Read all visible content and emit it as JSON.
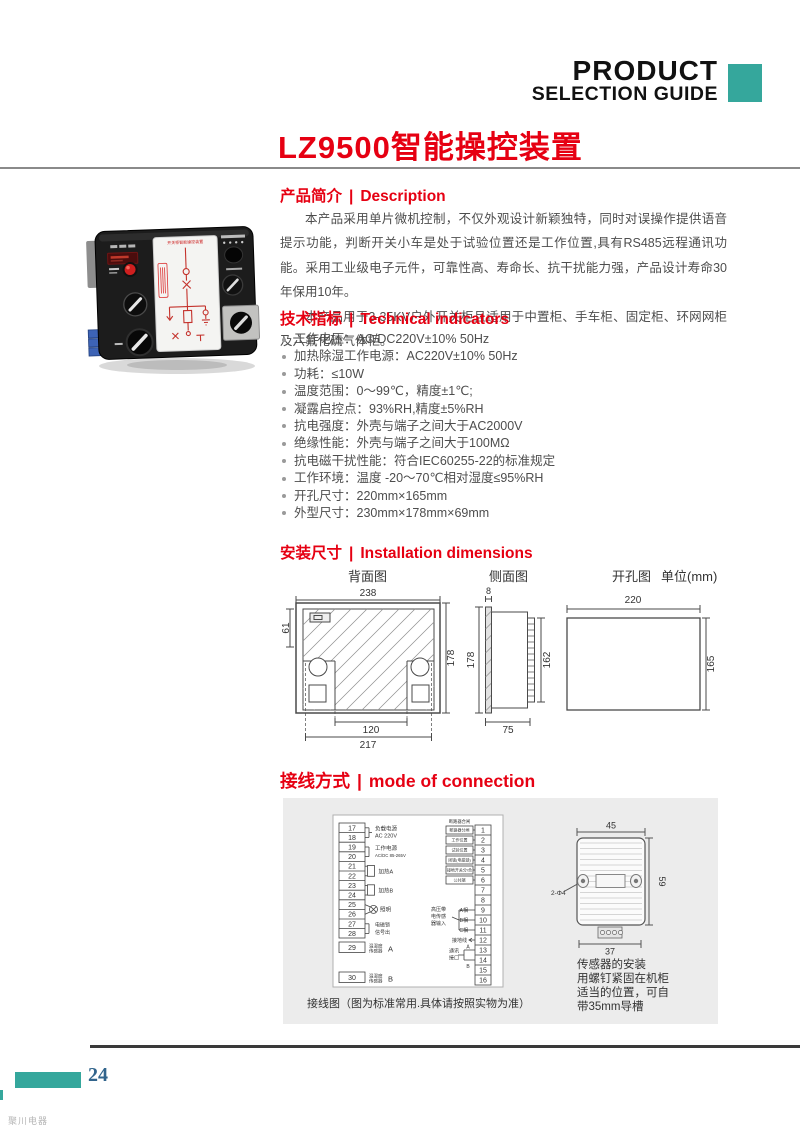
{
  "colors": {
    "accent_red": "#e60012",
    "teal": "#35a79c",
    "page_number_blue": "#31648c"
  },
  "header": {
    "brand_line1": "PRODUCT",
    "brand_line2": "SELECTION GUIDE"
  },
  "title": "LZ9500智能操控装置",
  "product_photo": {
    "panel_title": "开关柜智能操控装置"
  },
  "sections": {
    "description": {
      "zh": "产品简介",
      "divider": "|",
      "en": "Description",
      "para1": "本产品采用单片微机控制，不仅外观设计新颖独特，同时对误操作提供语音提示功能，判断开关小车是处于试验位置还是工作位置,具有RS485远程通讯功能。采用工业级电子元件，可靠性高、寿命长、抗干扰能力强，产品设计寿命30年保用10年。",
      "para2": "本产品用于3-35KV户外开关柜且适用于中置柜、手车柜、固定柜、环网网柜及六氟化硫气体柜。"
    },
    "tech": {
      "zh": "技术指标",
      "divider": "|",
      "en": "Technical indicators",
      "items": [
        "工作电压：AC/DC220V±10% 50Hz",
        "加热除湿工作电源：AC220V±10% 50Hz",
        "功耗：≤10W",
        "温度范围：0～99℃，精度±1℃;",
        "凝露启控点：93%RH,精度±5%RH",
        "抗电强度：外壳与端子之间大于AC2000V",
        "绝缘性能：外壳与端子之间大于100MΩ",
        "抗电磁干扰性能：符合IEC60255-22的标准规定",
        "工作环境：温度 -20～70℃相对湿度≤95%RH",
        "开孔尺寸：220mm×165mm",
        "外型尺寸：230mm×178mm×69mm"
      ]
    },
    "install": {
      "zh": "安装尺寸",
      "divider": "|",
      "en": "Installation dimensions",
      "back_view_label": "背面图",
      "side_view_label": "侧面图",
      "hole_view_label": "开孔图",
      "unit_label": "单位(mm)",
      "back_view": {
        "width": "238",
        "height": "178",
        "top_offset": "61",
        "slot_width": "120",
        "bottom_width": "217"
      },
      "side_view": {
        "panel_thickness": "8",
        "height": "178",
        "terminal_height": "162",
        "depth": "75"
      },
      "hole_view": {
        "width": "220",
        "height": "165"
      }
    },
    "connection": {
      "zh": "接线方式",
      "divider": "|",
      "en": "mode of connection",
      "caption": "接线图（图为标准常用.具体请按照实物为准）",
      "left": {
        "numbers": [
          "17",
          "18",
          "19",
          "20",
          "21",
          "22",
          "23",
          "24",
          "25",
          "26",
          "27",
          "28"
        ],
        "load_power_line1": "负载电源",
        "load_power_line2": "AC 220V",
        "work_power_line1": "工作电源",
        "work_power_line2": "AC/DC 85-265V",
        "heater_a": "加热A",
        "heater_b": "加热B",
        "lighting": "照明",
        "maglock_line1": "电磁锁",
        "maglock_line2": "信号出",
        "sensor_a_number": "29",
        "sensor_a_line1": "温湿度",
        "sensor_a_line2": "传感器",
        "sensor_a_tag": "A",
        "sensor_b_number": "30",
        "sensor_b_line1": "温湿度",
        "sensor_b_line2": "传感器",
        "sensor_b_tag": "B"
      },
      "right": {
        "numbers": [
          "1",
          "2",
          "3",
          "4",
          "5",
          "6",
          "7",
          "8",
          "9",
          "10",
          "11",
          "12",
          "13",
          "14",
          "15",
          "16"
        ],
        "header_label": "断路器合闸",
        "box_labels": [
          "断路器分闸",
          "工作位置",
          "试验位置",
          "闭锁(电磁锁)",
          "接地开关分/合",
          "公共端"
        ],
        "phases": [
          "A相",
          "B相",
          "C相"
        ],
        "hv_sensor_line1": "高压带",
        "hv_sensor_line2": "电传感",
        "hv_sensor_line3": "器输入",
        "ground_label": "接地线",
        "comm_line1": "通讯",
        "comm_line2": "接口",
        "comm_a": "A",
        "comm_b": "B"
      },
      "sensor": {
        "width": "45",
        "height": "59",
        "base_width": "37",
        "holes": "2-Φ4",
        "note_line1": "传感器的安装",
        "note_line2": "用螺钉紧固在机柜",
        "note_line3": "适当的位置，可自",
        "note_line4": "带35mm导槽"
      }
    }
  },
  "footer": {
    "page_number": "24",
    "watermark": "聚川电器"
  }
}
